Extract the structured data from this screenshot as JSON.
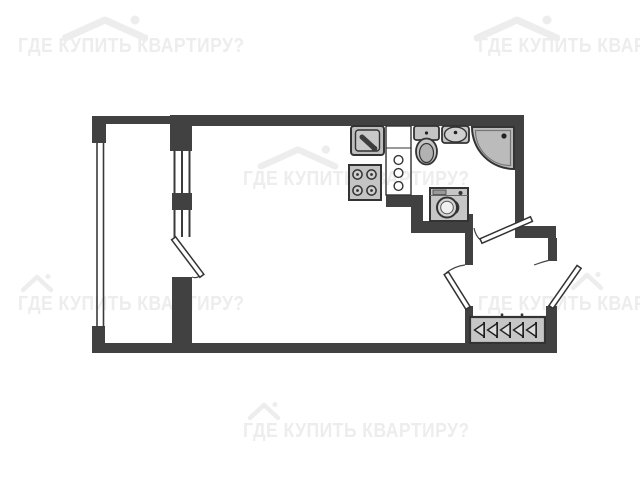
{
  "watermark": {
    "text": "ГДЕ КУПИТЬ КВАРТИРУ?",
    "color": "#ededed",
    "icon": "house-logo-icon",
    "instance_count": 6
  },
  "plan": {
    "type": "floor-plan",
    "wall_color": "#414141",
    "fixture_fill": "#c4c4c4",
    "background": "#ffffff",
    "rooms": [
      "main-room",
      "bathroom",
      "hallway",
      "balcony"
    ],
    "fixtures": [
      "kitchen-sink",
      "stove",
      "ventilation-shaft",
      "toilet",
      "washbasin",
      "shower-cabin",
      "washing-machine",
      "wardrobe-hangers"
    ],
    "doors": [
      "balcony-door",
      "bathroom-door",
      "room-door",
      "entrance-door"
    ],
    "windows": [
      "balcony-glazing",
      "window-upper",
      "window-lower"
    ],
    "hanger_count": 5
  }
}
